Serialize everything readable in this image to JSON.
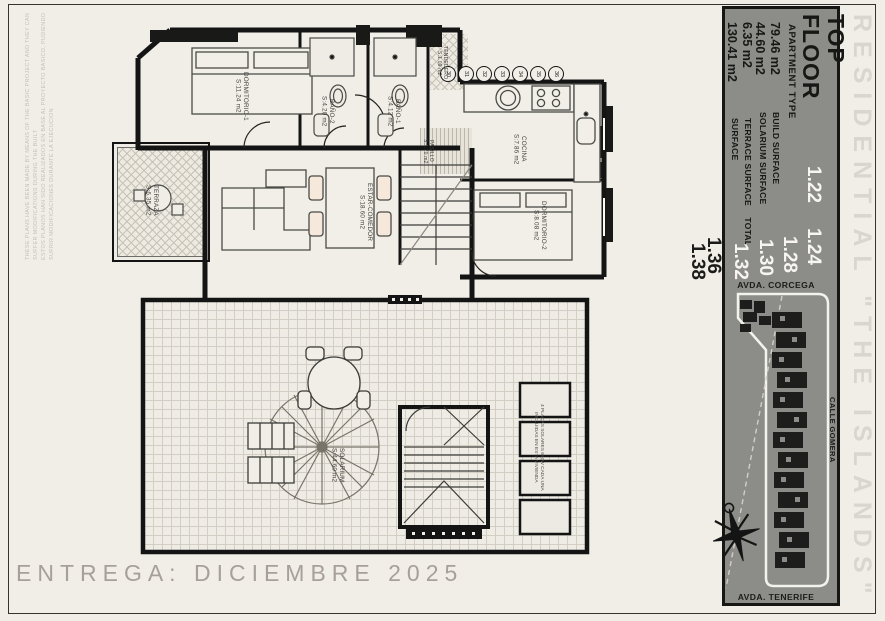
{
  "sheet": {
    "brand": "RESIDENTIAL \"THE ISLANDS\"",
    "delivery": "ENTREGA: DICIEMBRE 2025",
    "disclaimer_en": "THESE PLANS HAVE BEEN MADE BY MEANS OF THE BASIC PROJECT AND THEY CAN SUFFER MODIFICATIONS DURING THE BUILT",
    "disclaimer_es": "ESTOS PLANOS HAN SIDO REALIZADOS EN BASE AL PROYECTO BASICO, PUDIENDO SUFRIR MODIFICACIONES DURANTE LA EJECUCION"
  },
  "info_panel": {
    "floor_title_line1": "TOP",
    "floor_title_line2": "FLOOR",
    "apartment_type_label": "APARTMENT TYPE",
    "apartment_types_highlight": [
      "1.22",
      "1.24",
      "1.28",
      "1.30",
      "1.32"
    ],
    "apartment_types_other": [
      "1.36",
      "1.38"
    ],
    "surfaces": [
      {
        "label": "BUILD SURFACE",
        "value": "79.46 m2"
      },
      {
        "label": "SOLARIUM SURFACE",
        "value": "44.60 m2"
      },
      {
        "label": "TERRACE SURFACE",
        "value": "6.35 m2"
      },
      {
        "label": "TOTAL SURFACE",
        "value": "130.41 m2"
      }
    ]
  },
  "site_map": {
    "street_top": "AVDA. CORCEGA",
    "street_right": "CALLE GOMERA",
    "street_bottom": "AVDA. TENERIFE"
  },
  "floor_plan": {
    "rooms": [
      {
        "name": "DORMITORIO-1",
        "area": "S:11.24 m2"
      },
      {
        "name": "BAÑO-2",
        "area": "S:4.20 m2"
      },
      {
        "name": "BAÑO-1",
        "area": "S:4.12 m2"
      },
      {
        "name": "TENDEDERO",
        "area": "S:1.09 m2"
      },
      {
        "name": "PASILLO",
        "area": "S:1.70 m2"
      },
      {
        "name": "COCINA",
        "area": "S:7.86 m2"
      },
      {
        "name": "DORMITORIO-2",
        "area": "S:8.08 m2"
      },
      {
        "name": "ESTAR-COMEDOR",
        "area": "S:18.60 m2"
      },
      {
        "name": "TERRAZA",
        "area": "S:6.35 m2"
      }
    ],
    "position_numbers": [
      "30",
      "31",
      "32",
      "33",
      "34",
      "35",
      "36"
    ]
  },
  "solarium_plan": {
    "name": "SOLARIUM",
    "area": "S:44.60 m2",
    "solar_note_line1": "4 PLACAS SOLARES 600W CADA UNA",
    "solar_note_line2": "INCLUIDAS EN ESTA VIVIENDA"
  },
  "colors": {
    "panel_gray": "#8c8c88",
    "paper": "#f1eee8",
    "ink": "#141414",
    "highlight_number": "#f6f5f2"
  }
}
